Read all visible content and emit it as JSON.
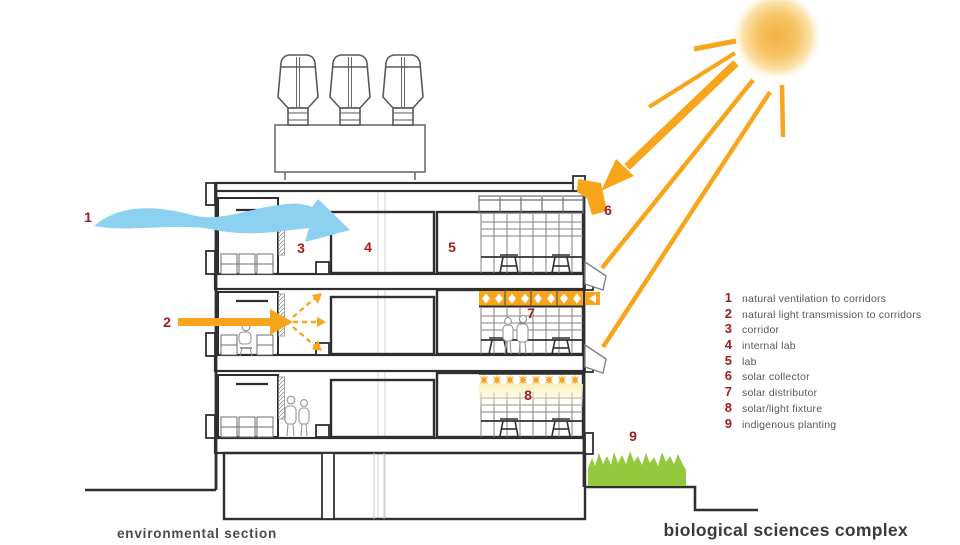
{
  "captions": {
    "left": "environmental section",
    "right": "biological sciences complex"
  },
  "markers": [
    "1",
    "2",
    "3",
    "4",
    "5",
    "6",
    "7",
    "8",
    "9"
  ],
  "legend": {
    "items": [
      {
        "num": "1",
        "label": "natural ventilation to corridors"
      },
      {
        "num": "2",
        "label": "natural light transmission to corridors"
      },
      {
        "num": "3",
        "label": "corridor"
      },
      {
        "num": "4",
        "label": "internal lab"
      },
      {
        "num": "5",
        "label": "lab"
      },
      {
        "num": "6",
        "label": "solar collector"
      },
      {
        "num": "7",
        "label": "solar distributor"
      },
      {
        "num": "8",
        "label": "solar/light fixture"
      },
      {
        "num": "9",
        "label": "indigenous planting"
      }
    ]
  },
  "colors": {
    "accent_orange": "#F9A51C",
    "sky_blue": "#8CD2F0",
    "marker_red": "#A01D20",
    "planting_green": "#94C93D",
    "structure_ink": "#2F2F31",
    "detail_gray": "#6D6E71"
  },
  "icons": {
    "sun-icon": "radial gradient disc with rays",
    "wind-arrow-icon": "wavy blue ribbon arrow",
    "light-arrow-icon": "solid orange arrow",
    "solar-ray-icon": "diagonal orange ray lines",
    "planting-icon": "green grass tuft block"
  }
}
